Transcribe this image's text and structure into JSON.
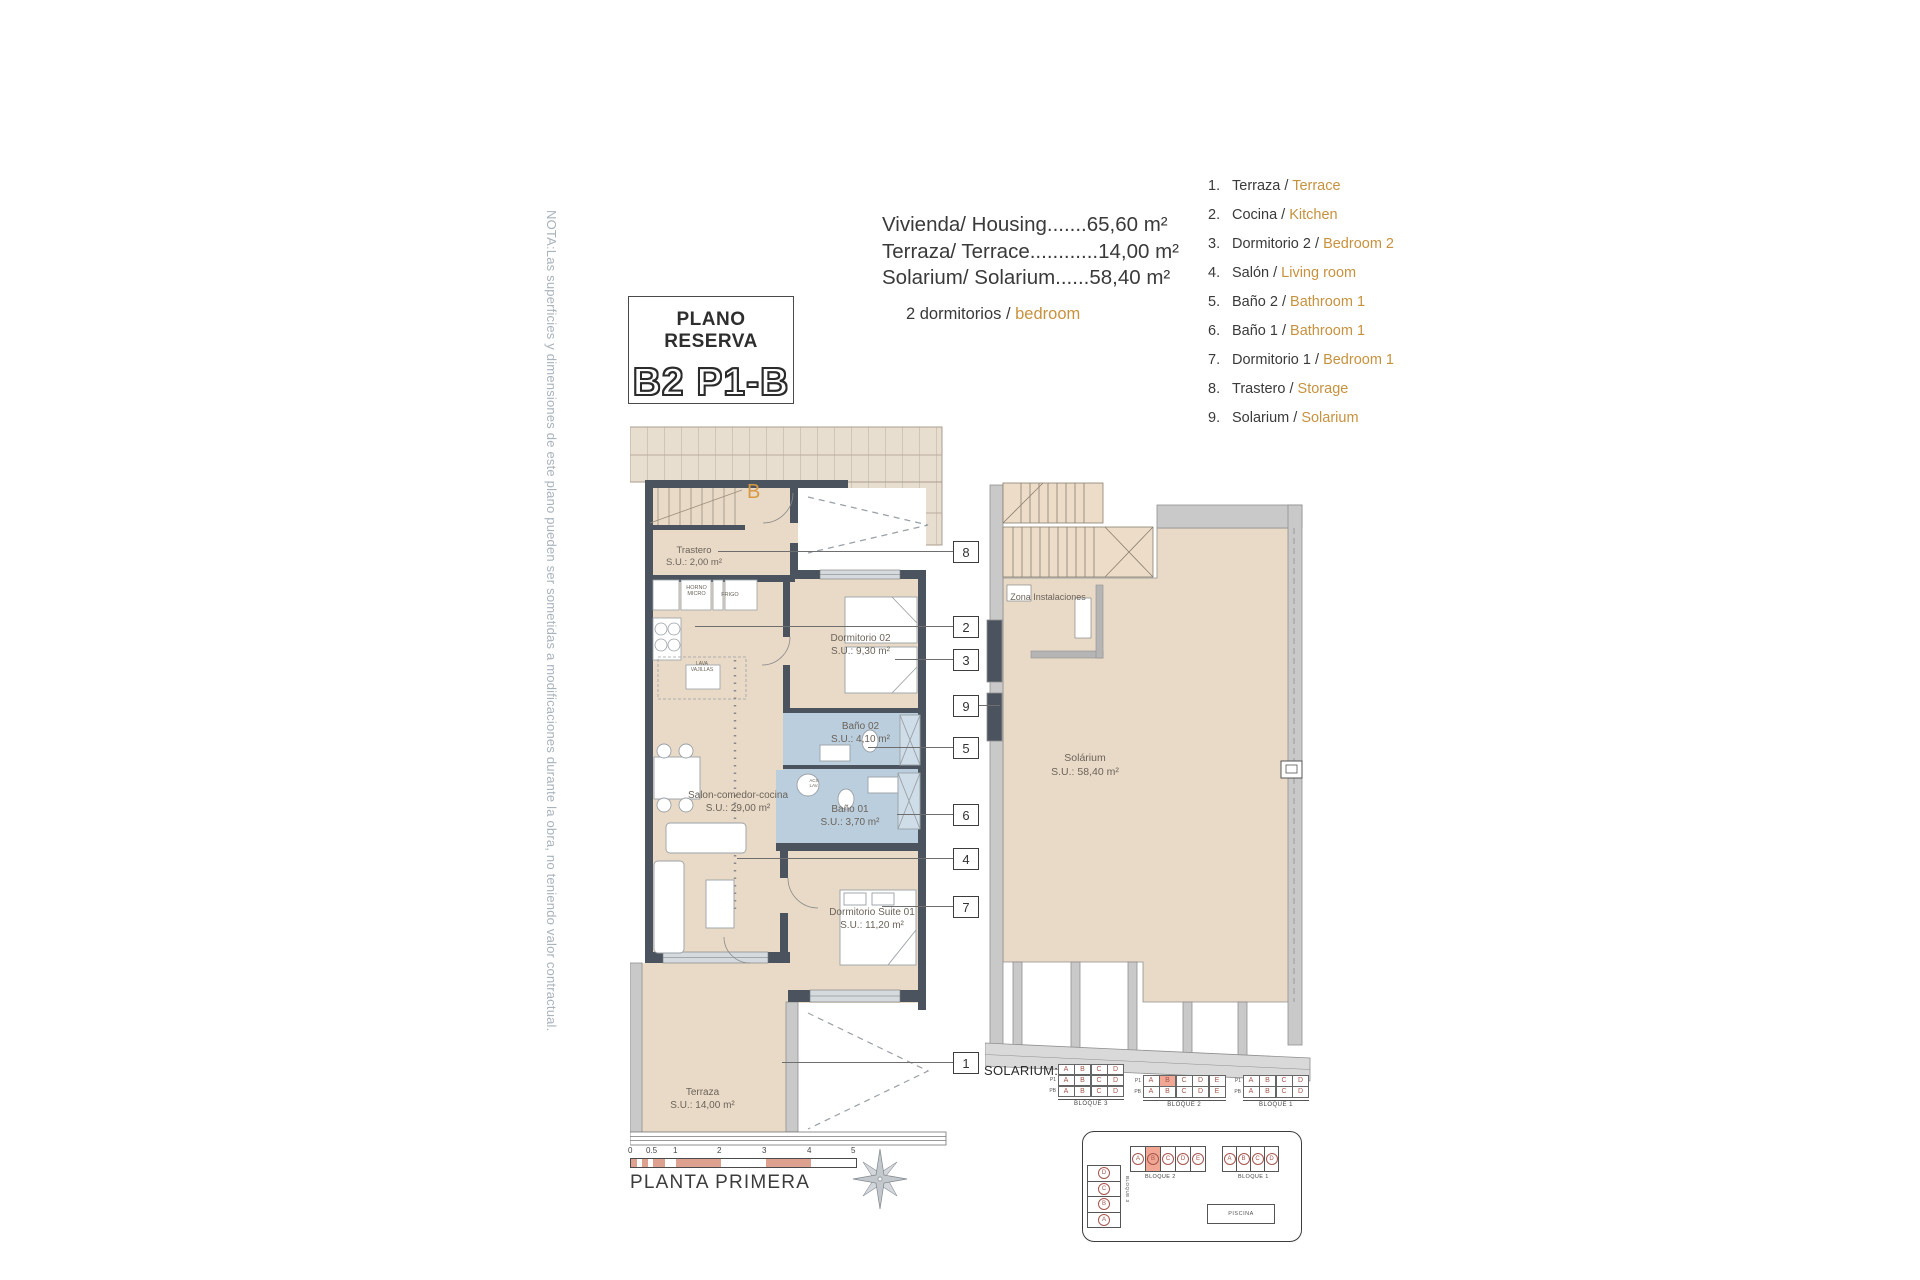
{
  "title_box": {
    "line1": "PLANO RESERVA",
    "line2": "B2 P1-B"
  },
  "note": "NOTA:Las superficies y dimensiones de este plano pueden ser sometidas a modificaciones durante la obra, no teniendo valor contractual.",
  "measurements": {
    "lines": [
      "Vivienda/ Housing.......65,60 m²",
      "Terraza/ Terrace............14,00 m²",
      "Solarium/ Solarium......58,40 m²"
    ],
    "bedrooms_prefix": "2 dormitorios / ",
    "bedrooms_accent": "bedroom"
  },
  "legend": {
    "items": [
      {
        "num": "1.",
        "es": "Terraza / ",
        "en": "Terrace"
      },
      {
        "num": "2.",
        "es": "Cocina / ",
        "en": "Kitchen"
      },
      {
        "num": "3.",
        "es": "Dormitorio 2 / ",
        "en": "Bedroom 2"
      },
      {
        "num": "4.",
        "es": "Salón / ",
        "en": "Living room"
      },
      {
        "num": "5.",
        "es": "Baño 2 / ",
        "en": "Bathroom 1"
      },
      {
        "num": "6.",
        "es": "Baño 1 / ",
        "en": "Bathroom 1"
      },
      {
        "num": "7.",
        "es": "Dormitorio 1 / ",
        "en": "Bedroom 1"
      },
      {
        "num": "8.",
        "es": "Trastero / ",
        "en": "Storage"
      },
      {
        "num": "9.",
        "es": "Solarium / ",
        "en": "Solarium"
      }
    ]
  },
  "plan": {
    "unit_letter": "B",
    "rooms": {
      "trastero": {
        "name": "Trastero",
        "area": "S.U.: 2,00 m²"
      },
      "dormitorio2": {
        "name": "Dormitorio 02",
        "area": "S.U.: 9,30 m²"
      },
      "bano2": {
        "name": "Baño 02",
        "area": "S.U.: 4,10 m²"
      },
      "bano1": {
        "name": "Baño 01",
        "area": "S.U.: 3,70 m²"
      },
      "salon": {
        "name": "Salon-comedor-cocina",
        "area": "S.U.: 29,00 m²"
      },
      "suite": {
        "name": "Dormitorio Suite 01",
        "area": "S.U.: 11,20 m²"
      },
      "terraza": {
        "name": "Terraza",
        "area": "S.U.: 14,00 m²"
      }
    },
    "kitchen": {
      "horno": "HORNO MICRO",
      "frigo": "FRIGO",
      "lava": "LAVA VAJILLAS",
      "acs": "ACS LAV."
    },
    "right": {
      "zona": "Zona Instalaciones",
      "name": "Solárium",
      "area": "S.U.: 58,40 m²"
    }
  },
  "callouts": [
    {
      "num": "8"
    },
    {
      "num": "2"
    },
    {
      "num": "3"
    },
    {
      "num": "9"
    },
    {
      "num": "5"
    },
    {
      "num": "6"
    },
    {
      "num": "4"
    },
    {
      "num": "7"
    },
    {
      "num": "1"
    }
  ],
  "scale": {
    "ticks": [
      "0",
      "0.5",
      "1",
      "2",
      "3",
      "4",
      "5"
    ]
  },
  "plan_title": "PLANTA PRIMERA",
  "solarium": {
    "label": "SOLARIUM:",
    "tables": [
      {
        "caption": "BLOQUE 3",
        "rows": [
          {
            "label": "",
            "cells": [
              "A",
              "B",
              "C",
              "D"
            ]
          },
          {
            "label": "P1",
            "cells": [
              "A",
              "B",
              "C",
              "D"
            ]
          },
          {
            "label": "PB",
            "cells": [
              "A",
              "B",
              "C",
              "D"
            ]
          }
        ]
      },
      {
        "caption": "BLOQUE 2",
        "rows": [
          {
            "label": "P1",
            "cells": [
              "A",
              "B",
              "C",
              "D",
              "E"
            ]
          },
          {
            "label": "PB",
            "cells": [
              "A",
              "B",
              "C",
              "D",
              "E"
            ]
          }
        ]
      },
      {
        "caption": "BLOQUE 1",
        "rows": [
          {
            "label": "P1",
            "cells": [
              "A",
              "B",
              "C",
              "D"
            ]
          },
          {
            "label": "PB",
            "cells": [
              "A",
              "B",
              "C",
              "D"
            ]
          }
        ]
      }
    ]
  },
  "site": {
    "top_blocks": [
      {
        "caption": "BLOQUE 2",
        "units": [
          "A",
          "B",
          "C",
          "D",
          "E"
        ]
      },
      {
        "caption": "BLOQUE 1",
        "units": [
          "A",
          "B",
          "C",
          "D"
        ]
      }
    ],
    "left_block": {
      "caption": "BLOQUE 3",
      "units": [
        "D",
        "C",
        "B",
        "A"
      ]
    },
    "piscina": "PISCINA"
  },
  "colors": {
    "accent_orange": "#c7923e",
    "beige": "#e9dac7",
    "bath_blue": "#bacede",
    "wall": "#4b545e",
    "salmon": "#f2a795",
    "note_gray": "#a9b3bc",
    "letter_red": "#a6554c"
  }
}
